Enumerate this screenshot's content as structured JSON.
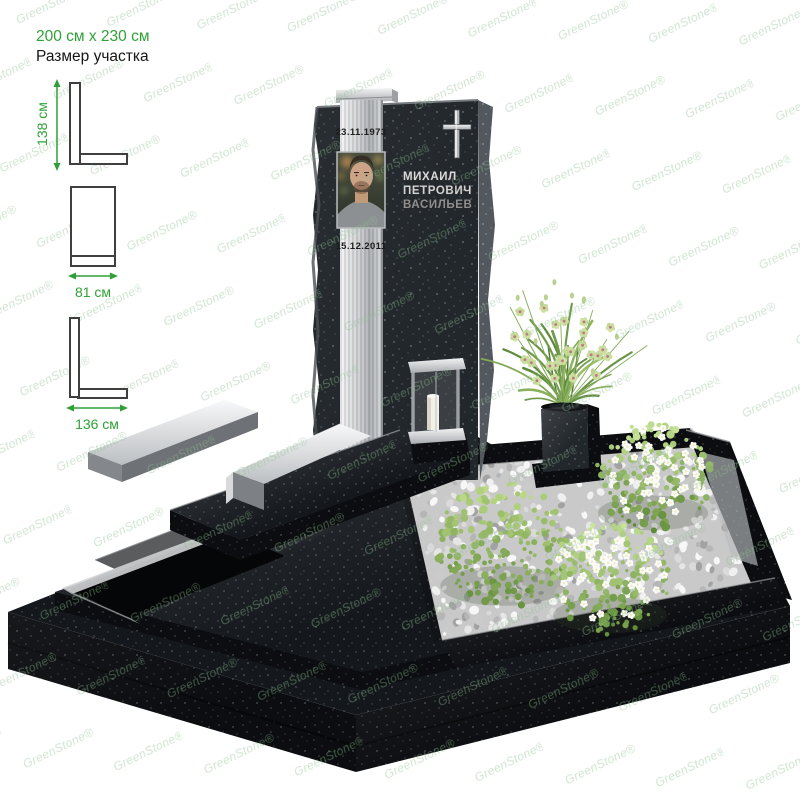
{
  "annotations": {
    "plot_size": "200 см x 230 см",
    "plot_size_caption": "Размер участка"
  },
  "dimensions": {
    "stela_height": "138 см",
    "stela_width": "81 см",
    "base_width": "136 см"
  },
  "monument": {
    "birth_date": "23.11.1973",
    "death_date": "15.12.2011",
    "name_line1": "МИХАИЛ",
    "name_line2": "ПЕТРОВИЧ",
    "name_line3": "ВАСИЛЬЕВ"
  },
  "watermark": {
    "text": "GreenStone®"
  },
  "colors": {
    "accent_green": "#2fa136",
    "diagram_line": "#3f3f3f",
    "granite_dark": "#0b0d10",
    "granite_mid": "#161a1e",
    "steel_light": "#e8e9eb",
    "name_text": "#d8d8d8",
    "gravel_light": "#ededed",
    "foliage_green": "#8cbf58",
    "flower_white": "#fbfbf8"
  }
}
